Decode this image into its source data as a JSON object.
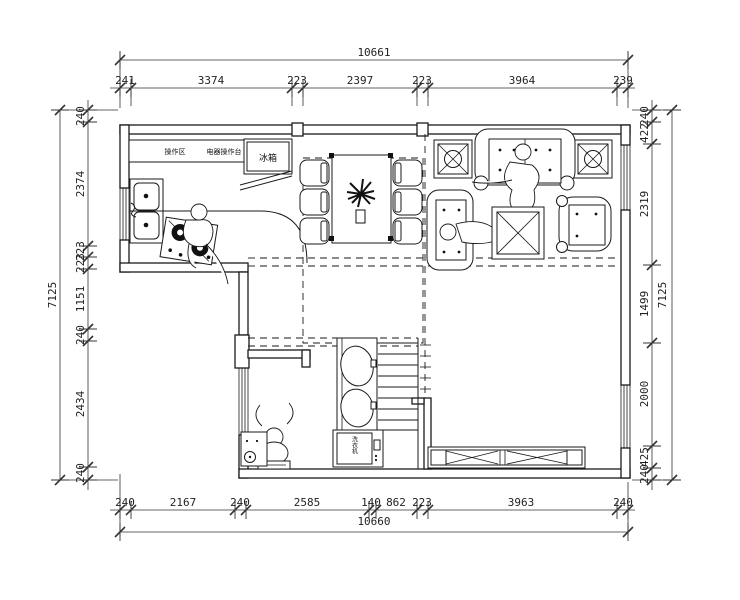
{
  "drawing": {
    "type": "architectural-floor-plan"
  },
  "dims": {
    "top": {
      "total": "10661",
      "segments": [
        "241",
        "3374",
        "223",
        "2397",
        "223",
        "3964",
        "239"
      ]
    },
    "bottom": {
      "total": "10660",
      "segments": [
        "240",
        "2167",
        "240",
        "2585",
        "140",
        "862",
        "223",
        "3963",
        "240"
      ]
    },
    "left": {
      "total": "7125",
      "segments": [
        "240",
        "2374",
        "223",
        "223",
        "1151",
        "240",
        "2434",
        "240"
      ]
    },
    "right": {
      "total": "7125",
      "segments": [
        "240",
        "422",
        "2319",
        "1499",
        "2000",
        "425",
        "240"
      ]
    }
  },
  "labels": {
    "prep_area": "操作区",
    "appliance_counter": "电器操作台",
    "fridge": "冰箱",
    "washing_machine": "洗衣机"
  },
  "colors": {
    "line": "#1a1a1a",
    "dim_text": "#222222",
    "background": "#ffffff"
  }
}
